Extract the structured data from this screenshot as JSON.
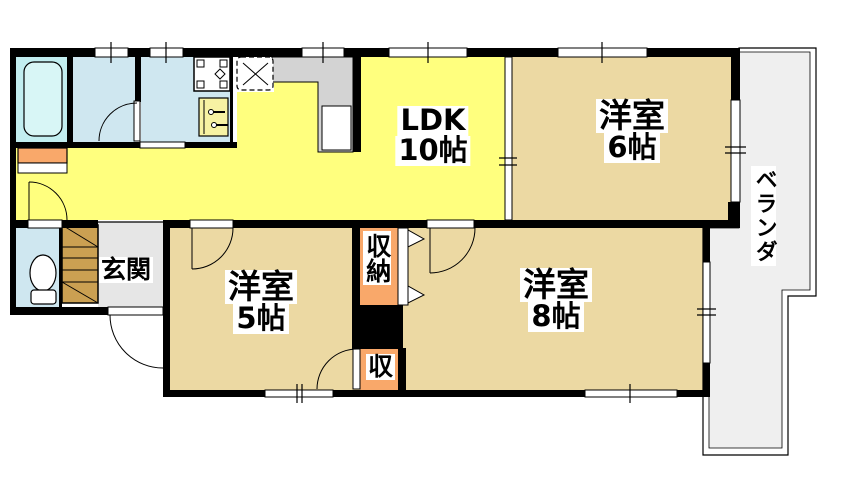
{
  "plan_title": "apartment-floor-plan",
  "colors": {
    "wall": "#000000",
    "ldk_floor": "#ffff7e",
    "bedroom_floor": "#ecd9a3",
    "balcony_floor": "#efefef",
    "water_room_floor": "#cfe7f0",
    "bath_floor": "#c2eef0",
    "bathtub": "#d8f6f6",
    "entrance_floor": "#e6e6e6",
    "counter": "#d3d3d3",
    "closet_orange": "#f9a86a",
    "shoe_cabinet": "#cba052",
    "washbasin": "#f7f2a3"
  },
  "labels": {
    "ldk_line1": "LDK",
    "ldk_line2": "10帖",
    "bedroom6_line1": "洋室",
    "bedroom6_line2": "6帖",
    "bedroom5_line1": "洋室",
    "bedroom5_line2": "5帖",
    "bedroom8_line1": "洋室",
    "bedroom8_line2": "8帖",
    "entrance": "玄関",
    "balcony": "ベランダ",
    "closet": "収納",
    "closet_small": "収"
  }
}
